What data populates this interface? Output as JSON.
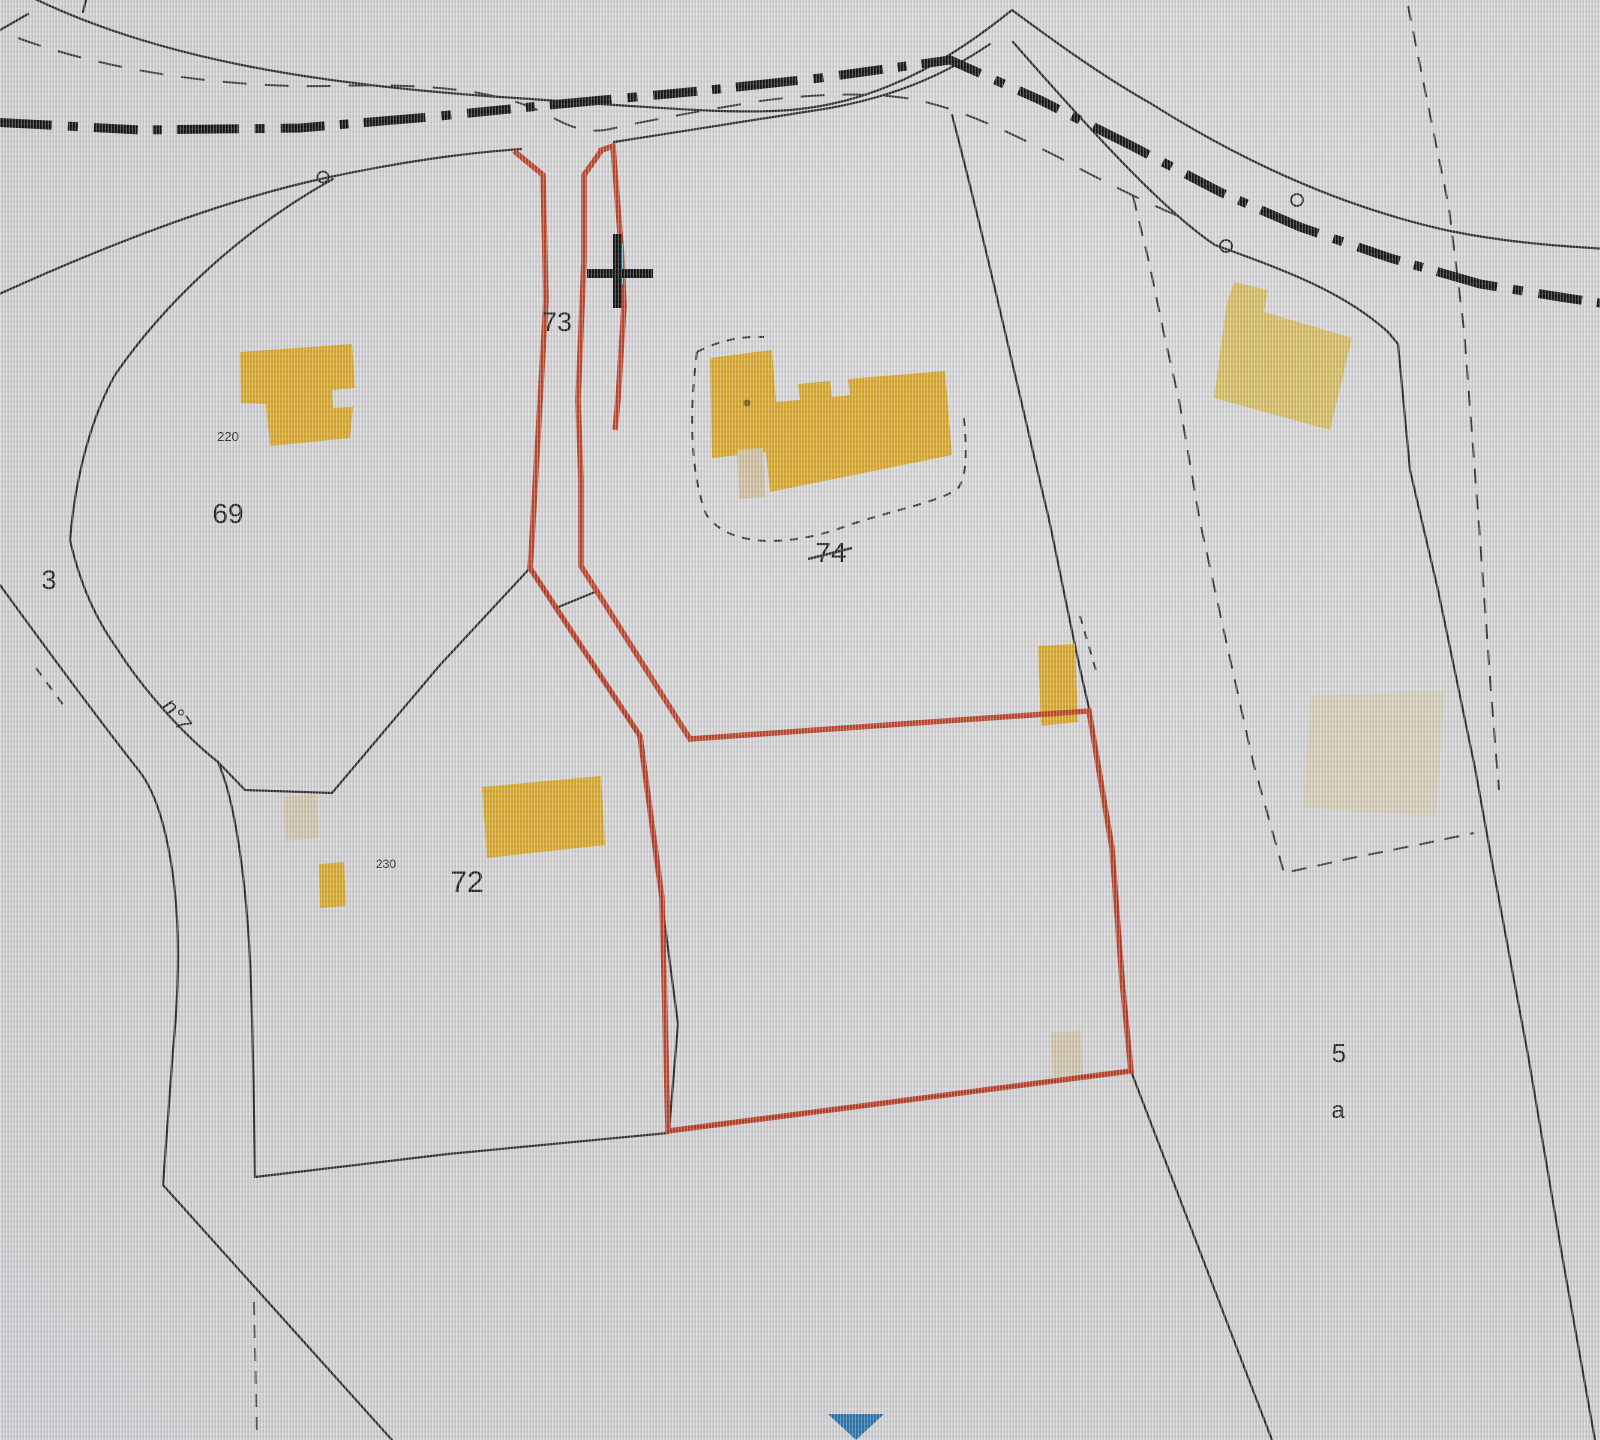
{
  "map": {
    "description": "cadastral parcel map",
    "labels": [
      {
        "text": "73",
        "kind": "parcel-number"
      },
      {
        "text": "69",
        "kind": "parcel-number"
      },
      {
        "text": "220",
        "kind": "building-number"
      },
      {
        "text": "3",
        "kind": "parcel-number"
      },
      {
        "text": "n°7",
        "kind": "road-name"
      },
      {
        "text": "230",
        "kind": "building-number"
      },
      {
        "text": "72",
        "kind": "parcel-number"
      },
      {
        "text": "74",
        "kind": "parcel-number"
      },
      {
        "text": "5",
        "kind": "parcel-number"
      },
      {
        "text": "a",
        "kind": "parcel-letter"
      }
    ]
  },
  "colors": {
    "background": "#d2d1d3",
    "parcel_line": "#2e2c2a",
    "dashed_line": "#3a3836",
    "road_dashdot": "#151515",
    "selection": "#b93a1f",
    "building": "#d9a82a",
    "building_light": "#d7bd64",
    "building_faint": "#d6c9a5",
    "building_pale": "#cfc0a0",
    "marker_blue": "#2a72a8",
    "cursor": "#121212",
    "edit_tick": "#85d6da",
    "label": "#201e1c"
  }
}
